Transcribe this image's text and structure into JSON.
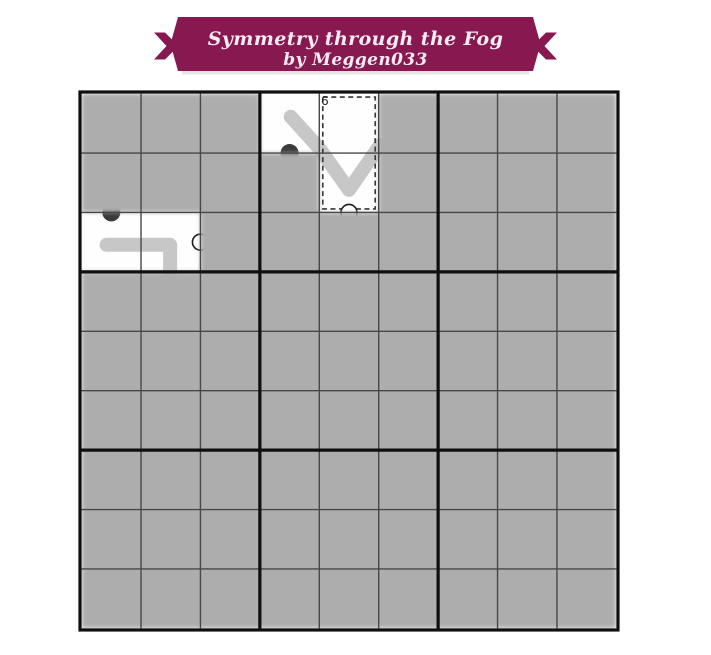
{
  "banner": {
    "title": "Symmetry through the Fog",
    "byline": "by Meggen033",
    "bg_color": "#871950",
    "text_color": "#f7ecf3"
  },
  "puzzle": {
    "rows": 9,
    "cols": 9,
    "box_size": 3,
    "colors": {
      "fog": "#adadad",
      "revealed": "#fefefe",
      "thin_line": "#474747",
      "thick_line": "#0f0f0f",
      "pencil_line": "#c7c7c7",
      "black_dot": "#3a3a3a",
      "white_circle_fill": "#ffffff",
      "white_circle_stroke": "#1a1a1a",
      "cage_stroke": "#333333",
      "digit": "#222222"
    },
    "revealed_cells": [
      [
        0,
        3
      ],
      [
        0,
        4
      ],
      [
        1,
        4
      ],
      [
        2,
        0
      ],
      [
        2,
        1
      ]
    ],
    "cages": [
      {
        "cells": [
          [
            0,
            4
          ],
          [
            1,
            4
          ]
        ],
        "label": "6"
      }
    ],
    "dots": [
      {
        "type": "black",
        "x": 3.5,
        "y": 1.0
      },
      {
        "type": "black",
        "x": 0.5,
        "y": 2.0
      },
      {
        "type": "white",
        "x": 2.0,
        "y": 2.5
      },
      {
        "type": "white",
        "x": 4.5,
        "y": 2.0
      }
    ],
    "lines": [
      {
        "points": [
          [
            3.52,
            0.39
          ],
          [
            4.01,
            0.93
          ],
          [
            4.5,
            1.62
          ],
          [
            5.02,
            0.87
          ]
        ]
      },
      {
        "points": [
          [
            0.42,
            2.545
          ],
          [
            1.49,
            2.545
          ],
          [
            1.49,
            3.08
          ]
        ]
      }
    ]
  }
}
